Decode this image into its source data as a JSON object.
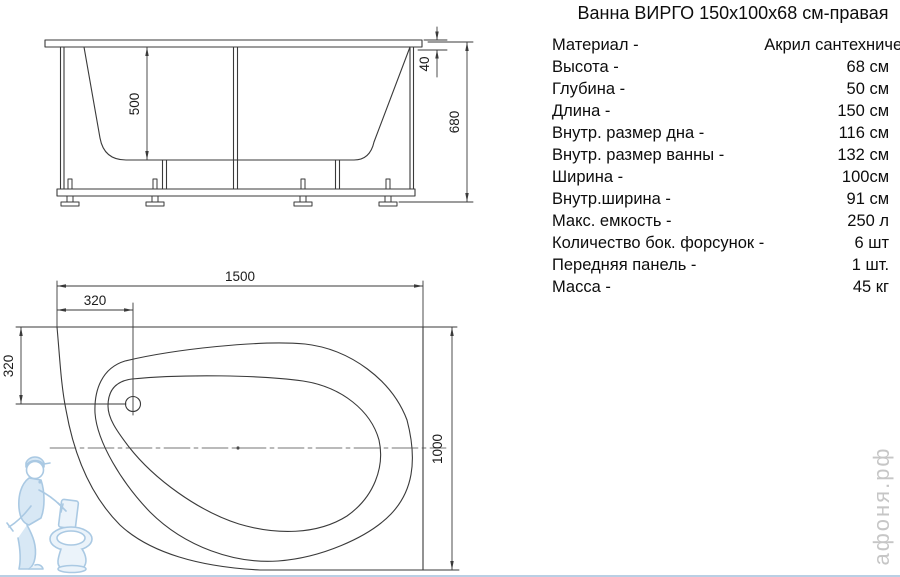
{
  "title": "Ванна ВИРГО 150x100x68 см-правая",
  "specs": {
    "rows": [
      {
        "label": "Материал -",
        "value": "Акрил сантехнический"
      },
      {
        "label": "Высота -",
        "value": "68 см"
      },
      {
        "label": "Глубина -",
        "value": "50 см"
      },
      {
        "label": "Длина -",
        "value": "150 см"
      },
      {
        "label": "Внутр. размер дна -",
        "value": "116 см"
      },
      {
        "label": "Внутр. размер ванны -",
        "value": "132 см"
      },
      {
        "label": "Ширина -",
        "value": "100см"
      },
      {
        "label": "Внутр.ширина -",
        "value": "91 см"
      },
      {
        "label": "Макс. емкость -",
        "value": "250 л"
      },
      {
        "label": "Количество бок. форсунок -",
        "value": "6 шт"
      },
      {
        "label": "Передняя панель -",
        "value": "1 шт."
      },
      {
        "label": "Масса -",
        "value": "45 кг"
      }
    ]
  },
  "front_view": {
    "dim_depth": "500",
    "dim_rim": "40",
    "dim_height": "680"
  },
  "plan_view": {
    "dim_length": "1500",
    "dim_drain_x": "320",
    "dim_drain_y": "320",
    "dim_width": "1000"
  },
  "watermark": {
    "site": "афоня.рф"
  },
  "colors": {
    "line": "#3a3a3a",
    "watermark_blue": "#a6c7e2",
    "watermark_gray": "#c6c6c6",
    "bottom_line": "#b9cfe4"
  }
}
